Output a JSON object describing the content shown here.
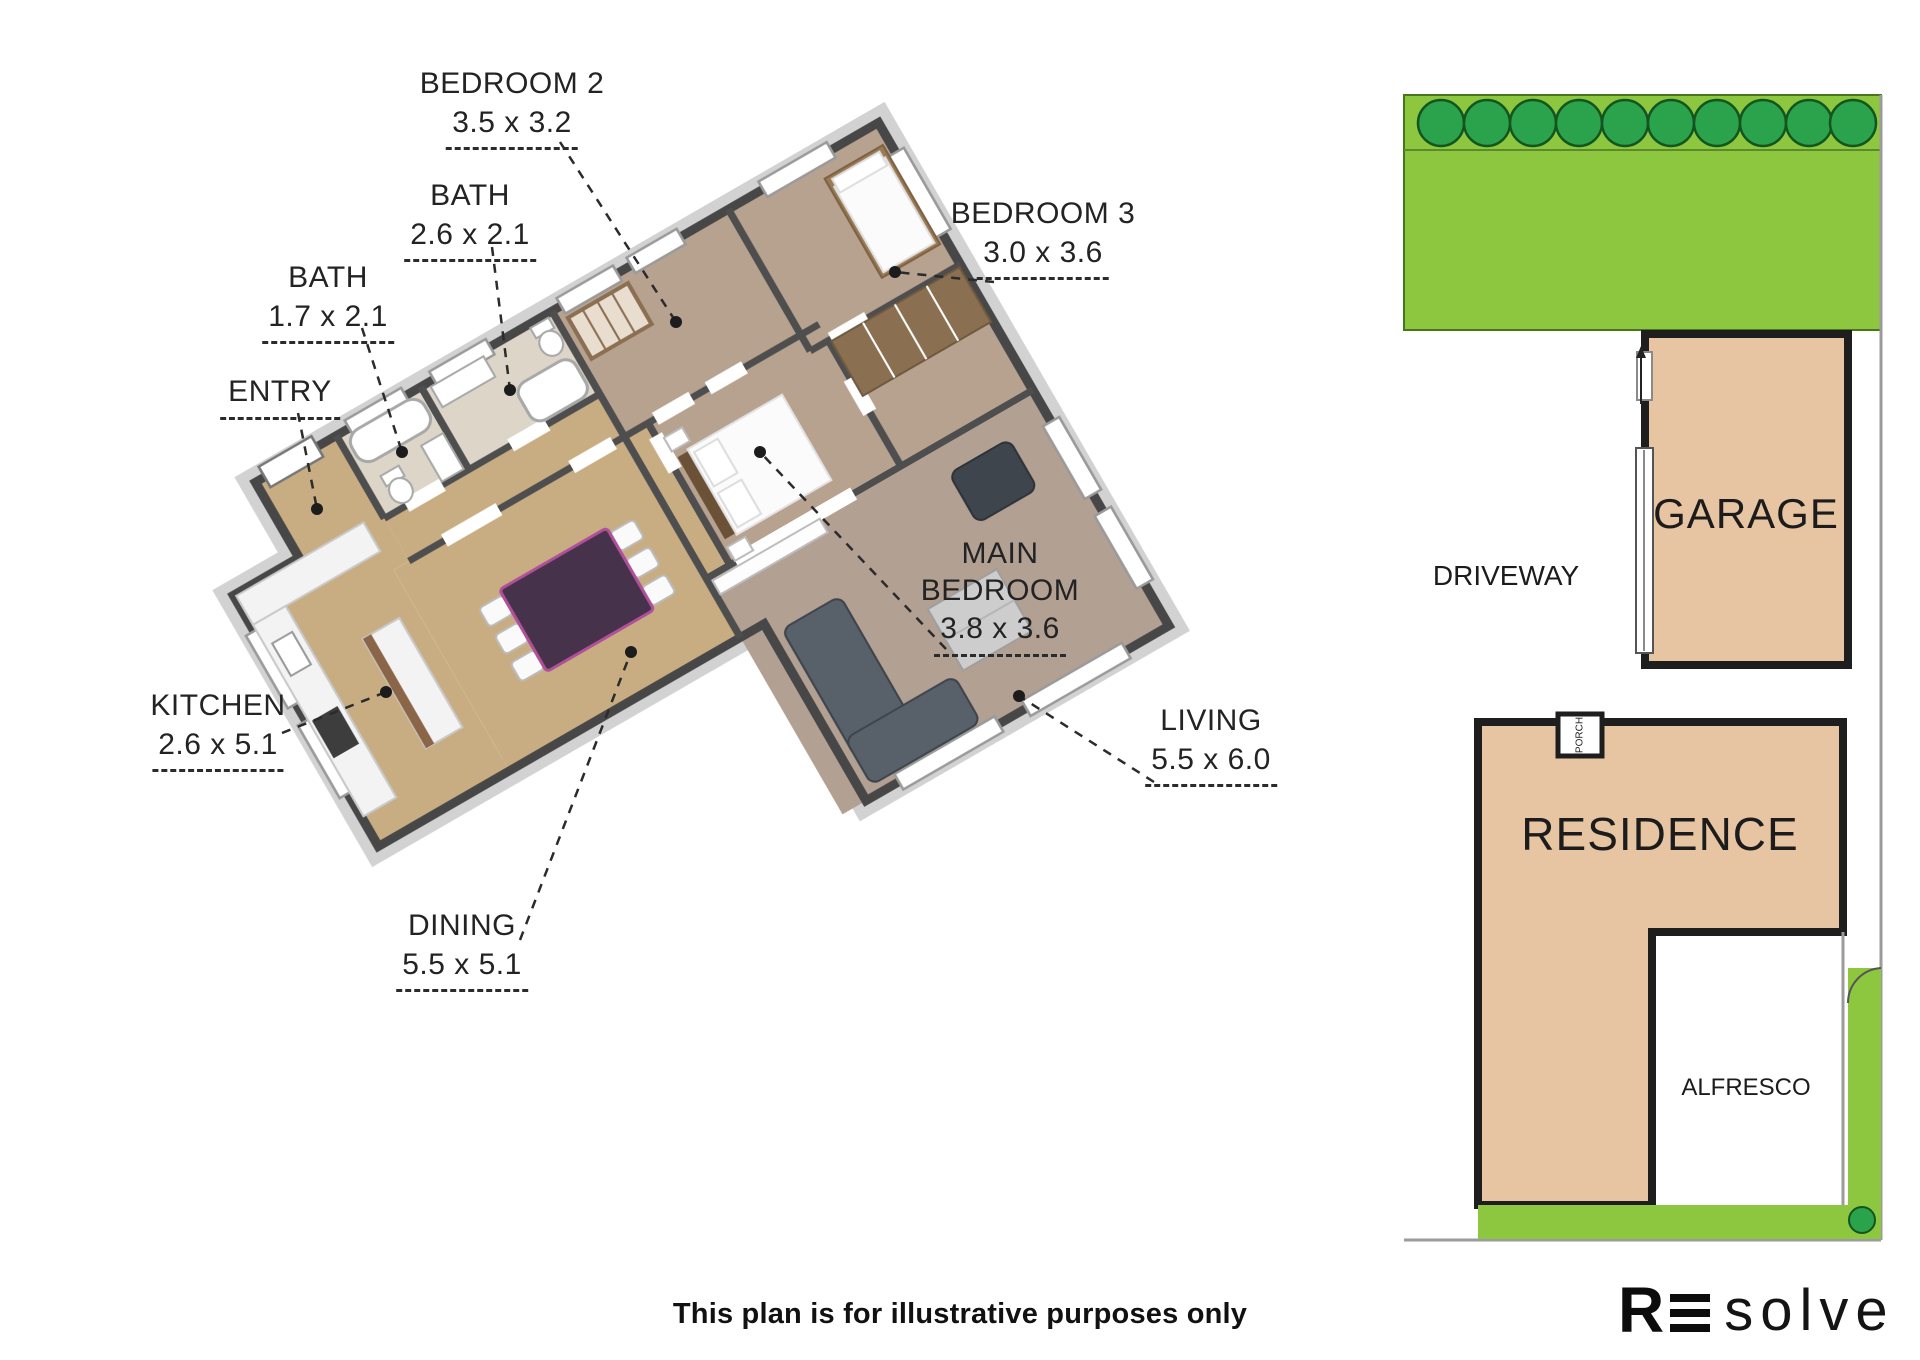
{
  "floor_plan": {
    "labels": [
      {
        "name": "BEDROOM 2",
        "dims": "3.5 x 3.2"
      },
      {
        "name": "BATH",
        "dims": "2.6 x 2.1"
      },
      {
        "name": "BATH",
        "dims": "1.7 x 2.1"
      },
      {
        "name": "ENTRY",
        "dims": ""
      },
      {
        "name": "KITCHEN",
        "dims": "2.6 x 5.1"
      },
      {
        "name": "DINING",
        "dims": "5.5 x 5.1"
      },
      {
        "name": "MAIN BEDROOM",
        "dims": "3.8 x 3.6"
      },
      {
        "name": "BEDROOM 3",
        "dims": "3.0 x 3.6"
      },
      {
        "name": "LIVING",
        "dims": "5.5 x 6.0"
      }
    ]
  },
  "site_plan": {
    "garage_label": "GARAGE",
    "driveway_label": "DRIVEWAY",
    "residence_label": "RESIDENCE",
    "alfresco_label": "ALFRESCO",
    "porch_label": "PORCH",
    "colors": {
      "lawn": "#8dc63f",
      "lawn_edge": "#47761c",
      "tree": "#2aa34c",
      "tree_edge": "#14551f",
      "building_fill": "#e8c5a2",
      "wall": "#1e1e1e",
      "boundary": "#9b9b9b"
    }
  },
  "footer": {
    "disclaimer": "This plan is for illustrative purposes only",
    "logo": {
      "r": "R",
      "word": "solve"
    }
  }
}
